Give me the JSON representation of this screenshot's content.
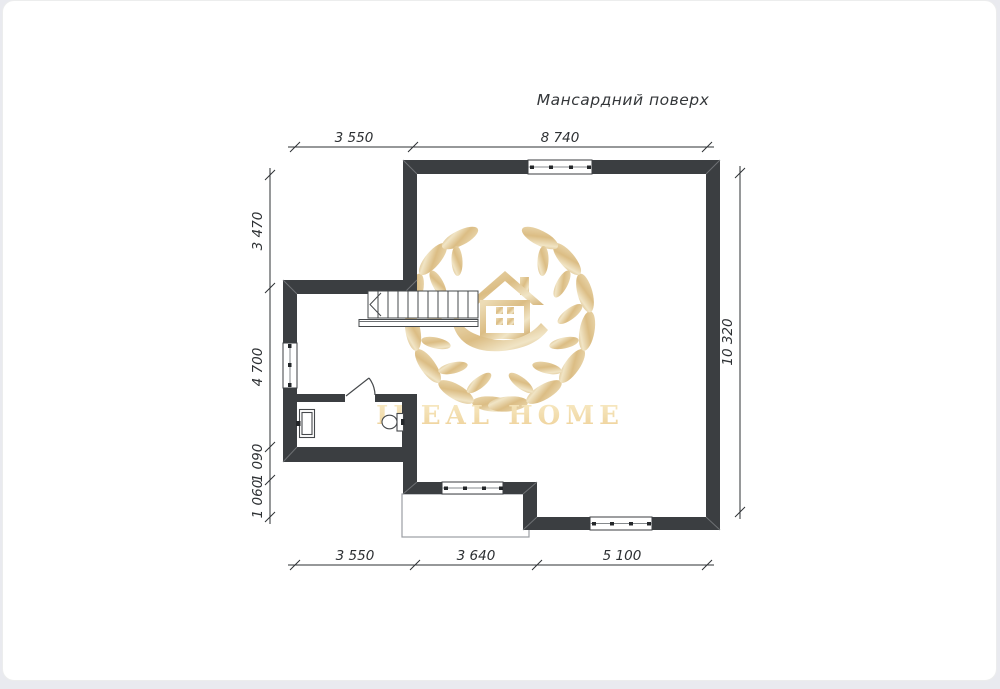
{
  "page": {
    "title": "Мансардний поверх"
  },
  "watermark": {
    "brand": "IDEAL HOME",
    "icon": "house-in-hand-with-laurel-wreath",
    "gold_light": "#f2e3bd",
    "gold_mid": "#ddbd79",
    "gold_dark": "#c9a057"
  },
  "plan": {
    "wall_color": "#3b3e41",
    "line_color": "#2d3033",
    "elements": [
      "stairs",
      "bathroom-door",
      "sink",
      "toilet",
      "balcony",
      "windows"
    ]
  },
  "dimensions": {
    "top": {
      "d1": "3 550",
      "d2": "8 740"
    },
    "bottom": {
      "d1": "3 550",
      "d2": "3 640",
      "d3": "5 100"
    },
    "left": {
      "d1": "3 470",
      "d2": "4 700",
      "d3": "1 090",
      "d4": "1 060"
    },
    "right": {
      "d1": "10 320"
    }
  }
}
